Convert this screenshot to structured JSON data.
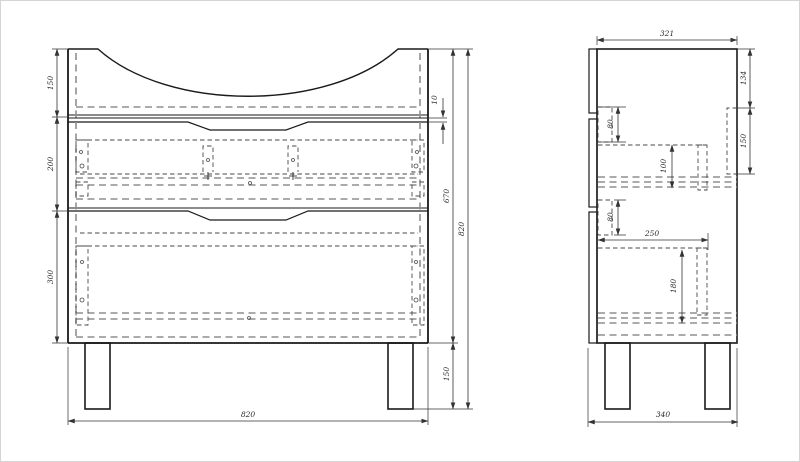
{
  "drawing": {
    "kind": "furniture-technical-drawing",
    "colors": {
      "outline": "#1a1a1a",
      "dashed_gray": "#8f8f8f",
      "dashed_dark": "#4a4a4a",
      "dimension": "#333333",
      "background": "#ffffff"
    },
    "front_view": {
      "dimensions": {
        "top_section_height": "150",
        "drawer1_height": "200",
        "drawer2_height": "300",
        "top_gap": "10",
        "carcass_height": "670",
        "total_height": "820",
        "leg_height": "150",
        "width": "820"
      }
    },
    "side_view": {
      "dimensions": {
        "top_width": "321",
        "back_offset": "134",
        "back_rail_height": "150",
        "slide_offset_upper": "80",
        "slide_plate_height": "100",
        "slide_offset_lower": "80",
        "slide_length": "250",
        "drawer_box_height": "180",
        "total_depth": "340"
      }
    }
  }
}
